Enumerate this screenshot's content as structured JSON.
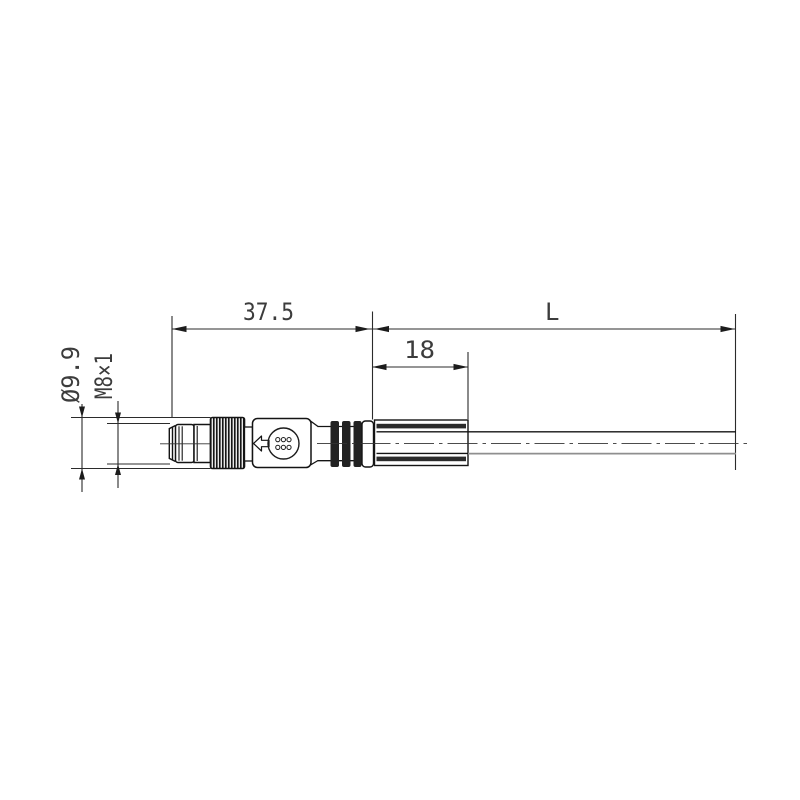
{
  "drawing": {
    "description": "Technical dimension drawing of an M8 male circular connector with knurled coupling nut, molded sleeve and cable",
    "dimension_labels": {
      "connector_length": "37.5",
      "cable_length": "L",
      "sleeve_length": "18",
      "nut_diameter": "Ø9.9",
      "thread_size": "M8×1"
    },
    "icons": {
      "manufacturer_logo": "manufacturer-logo-icon",
      "orientation_arrow": "orientation-arrow-icon"
    },
    "colors": {
      "outline": "#141414",
      "dimension_line": "#2b2b2b",
      "dimension_text": "#3c3c3c",
      "rib_fill": "#222222",
      "sleeve_band": "#2b2b2b",
      "cable_shade_line": "#8f8f8f",
      "centerline": "#333333",
      "background": "#ffffff"
    }
  }
}
